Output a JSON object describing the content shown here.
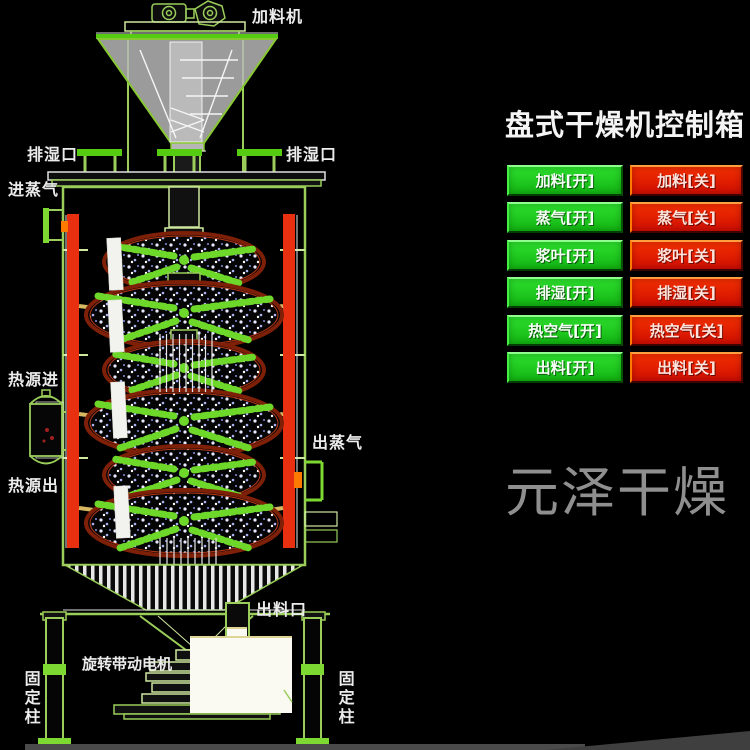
{
  "watermark": "元泽干燥",
  "panel": {
    "title": "盘式干燥机控制箱",
    "green_buttons": [
      {
        "label": "加料[开]"
      },
      {
        "label": "蒸气[开]"
      },
      {
        "label": "浆叶[开]"
      },
      {
        "label": "排湿[开]"
      },
      {
        "label": "热空气[开]"
      },
      {
        "label": "出料[开]"
      }
    ],
    "red_buttons": [
      {
        "label": "加料[关]"
      },
      {
        "label": "蒸气[关]"
      },
      {
        "label": "浆叶[关]"
      },
      {
        "label": "排湿[关]"
      },
      {
        "label": "热空气[关]"
      },
      {
        "label": "出料[关]"
      }
    ],
    "colors": {
      "on_green": "#1dcc1d",
      "off_red": "#e91500"
    }
  },
  "diagram": {
    "labels": {
      "feeder": "加料机",
      "moisture_outlet_left": "排湿口",
      "moisture_outlet_right": "排湿口",
      "steam_inlet": "进蒸气",
      "heat_source_in": "热源进",
      "steam_outlet": "出蒸气",
      "heat_source_out": "热源出",
      "discharge_outlet": "出料口",
      "drive_motor": "旋转带动电机",
      "fixed_column_left": "固定柱",
      "fixed_column_right": "固定柱"
    },
    "colors": {
      "line_green": "#9acd5a",
      "bright_green": "#55cc11",
      "pipe_red": "#e83010",
      "tray_rim": "#7e2008",
      "paddle_green": "#6ed82a"
    }
  }
}
